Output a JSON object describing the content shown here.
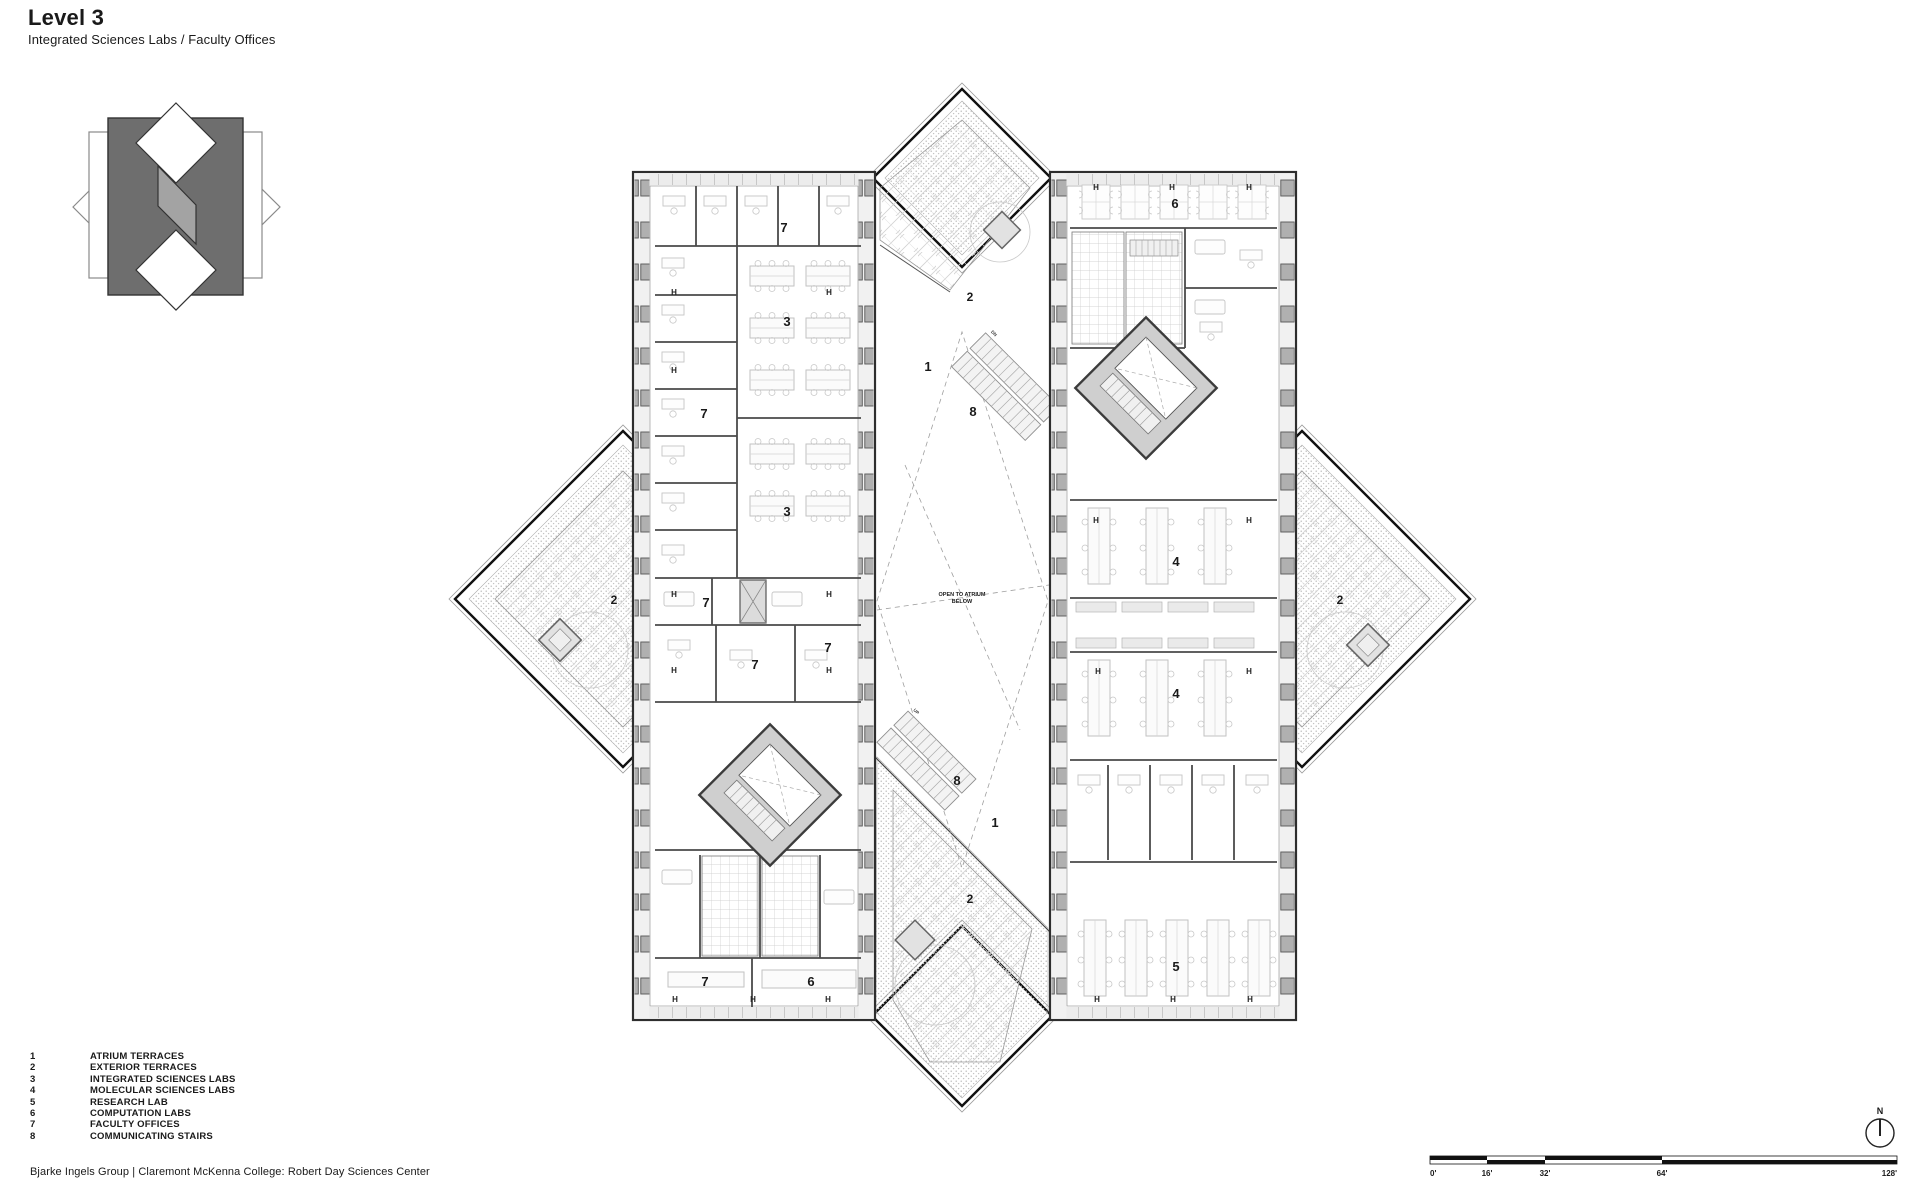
{
  "header": {
    "title": "Level 3",
    "subtitle": "Integrated Sciences Labs / Faculty Offices"
  },
  "legend": {
    "items": [
      {
        "num": "1",
        "label": "ATRIUM TERRACES"
      },
      {
        "num": "2",
        "label": "EXTERIOR TERRACES"
      },
      {
        "num": "3",
        "label": "INTEGRATED SCIENCES LABS"
      },
      {
        "num": "4",
        "label": "MOLECULAR SCIENCES LABS"
      },
      {
        "num": "5",
        "label": "RESEARCH LAB"
      },
      {
        "num": "6",
        "label": "COMPUTATION LABS"
      },
      {
        "num": "7",
        "label": "FACULTY OFFICES"
      },
      {
        "num": "8",
        "label": "COMMUNICATING STAIRS"
      }
    ]
  },
  "footer": {
    "credit": "Bjarke Ingels Group | Claremont McKenna College: Robert Day Sciences Center"
  },
  "scalebar": {
    "ticks": [
      "0'",
      "16'",
      "32'",
      "64'",
      "128'"
    ]
  },
  "north": {
    "label": "N"
  },
  "plan": {
    "room_labels": [
      "7",
      "3",
      "7",
      "3",
      "7",
      "7",
      "7",
      "2",
      "1",
      "8",
      "2",
      "2",
      "6",
      "4",
      "4",
      "8",
      "1",
      "2",
      "5",
      "7",
      "6"
    ],
    "open_atrium_line1": "OPEN TO ATRIUM",
    "open_atrium_line2": "BELOW",
    "h_marker": "H",
    "stair_dn": "DN",
    "stair_up": "UP",
    "colors": {
      "ink": "#1a1a1a",
      "heavy_outline": "#111111",
      "wall": "#4a4a4a",
      "column_fill": "#aeaeae",
      "light_fill": "#f0f0f0",
      "core_fill": "#cfcfcf",
      "logo_dark": "#6e6e6e",
      "logo_mid": "#a3a3a3"
    }
  }
}
